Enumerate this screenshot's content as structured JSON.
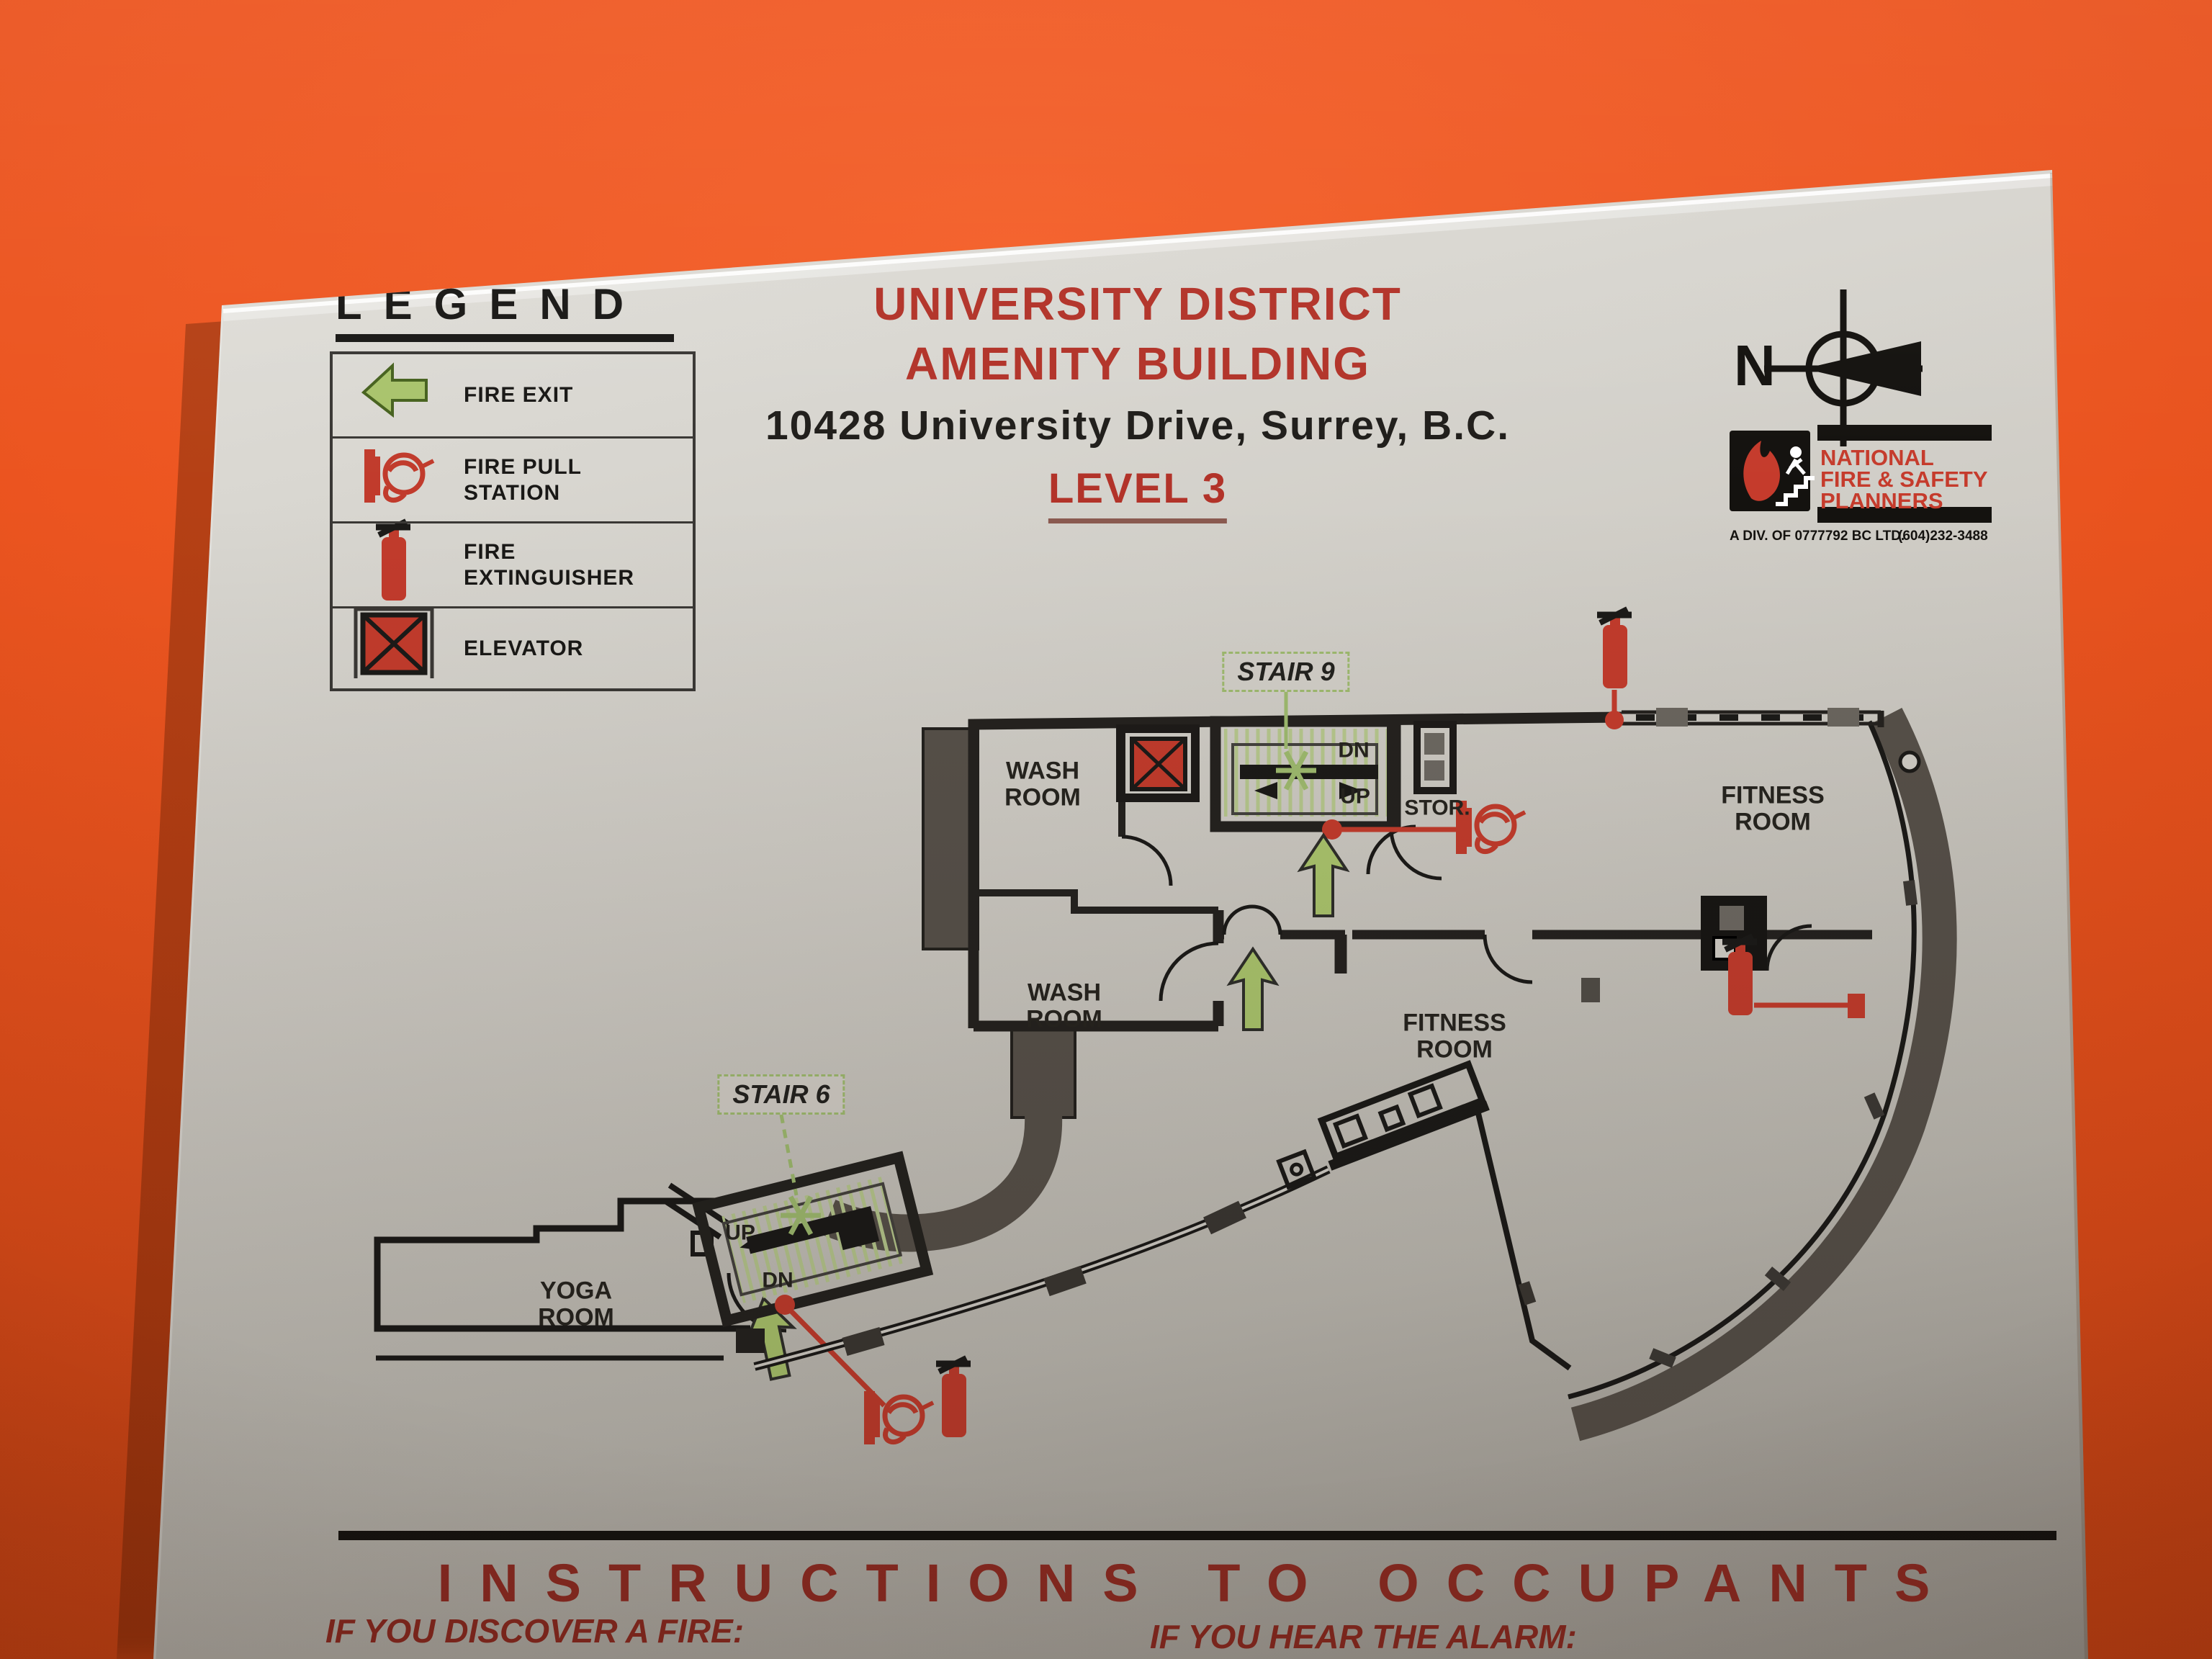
{
  "sign": {
    "legend": {
      "title": "LEGEND",
      "items": [
        {
          "icon": "fire-exit-arrow-icon",
          "label": "FIRE EXIT"
        },
        {
          "icon": "fire-pull-station-icon",
          "label": "FIRE PULL\nSTATION"
        },
        {
          "icon": "fire-extinguisher-icon",
          "label": "FIRE\nEXTINGUISHER"
        },
        {
          "icon": "elevator-icon",
          "label": "ELEVATOR"
        }
      ]
    },
    "title_line1": "UNIVERSITY DISTRICT",
    "title_line2": "AMENITY BUILDING",
    "address": "10428 University Drive, Surrey, B.C.",
    "level": "LEVEL 3",
    "compass_label": "N",
    "logo": {
      "name_line1": "NATIONAL",
      "name_line2": "FIRE & SAFETY",
      "name_line3": "PLANNERS",
      "division": "A DIV. OF 0777792 BC LTD.",
      "phone": "(604)232-3488"
    },
    "plan": {
      "stair9_label": "STAIR 9",
      "stair6_label": "STAIR 6",
      "washroom_label": "WASH\nROOM",
      "washroom2_label": "WASH\nROOM",
      "storage_label": "STOR.",
      "fitness_label": "FITNESS\nROOM",
      "fitness2_label": "FITNESS\nROOM",
      "yoga_label": "YOGA\nROOM",
      "up_label": "UP",
      "up2_label": "UP",
      "down_label": "DN",
      "down2_label": "DN"
    },
    "instructions": {
      "heading": "INSTRUCTIONS TO OCCUPANTS",
      "col1_heading": "IF YOU DISCOVER A FIRE:",
      "col2_heading": "IF YOU HEAR THE ALARM:"
    },
    "colors": {
      "wall_orange": "#ec5520",
      "panel_silver": "#cfccc5",
      "accent_red": "#c13b2c",
      "exit_green": "#a9c36c",
      "plan_wall_gray": "#565049",
      "ink_black": "#1b1a18"
    }
  }
}
